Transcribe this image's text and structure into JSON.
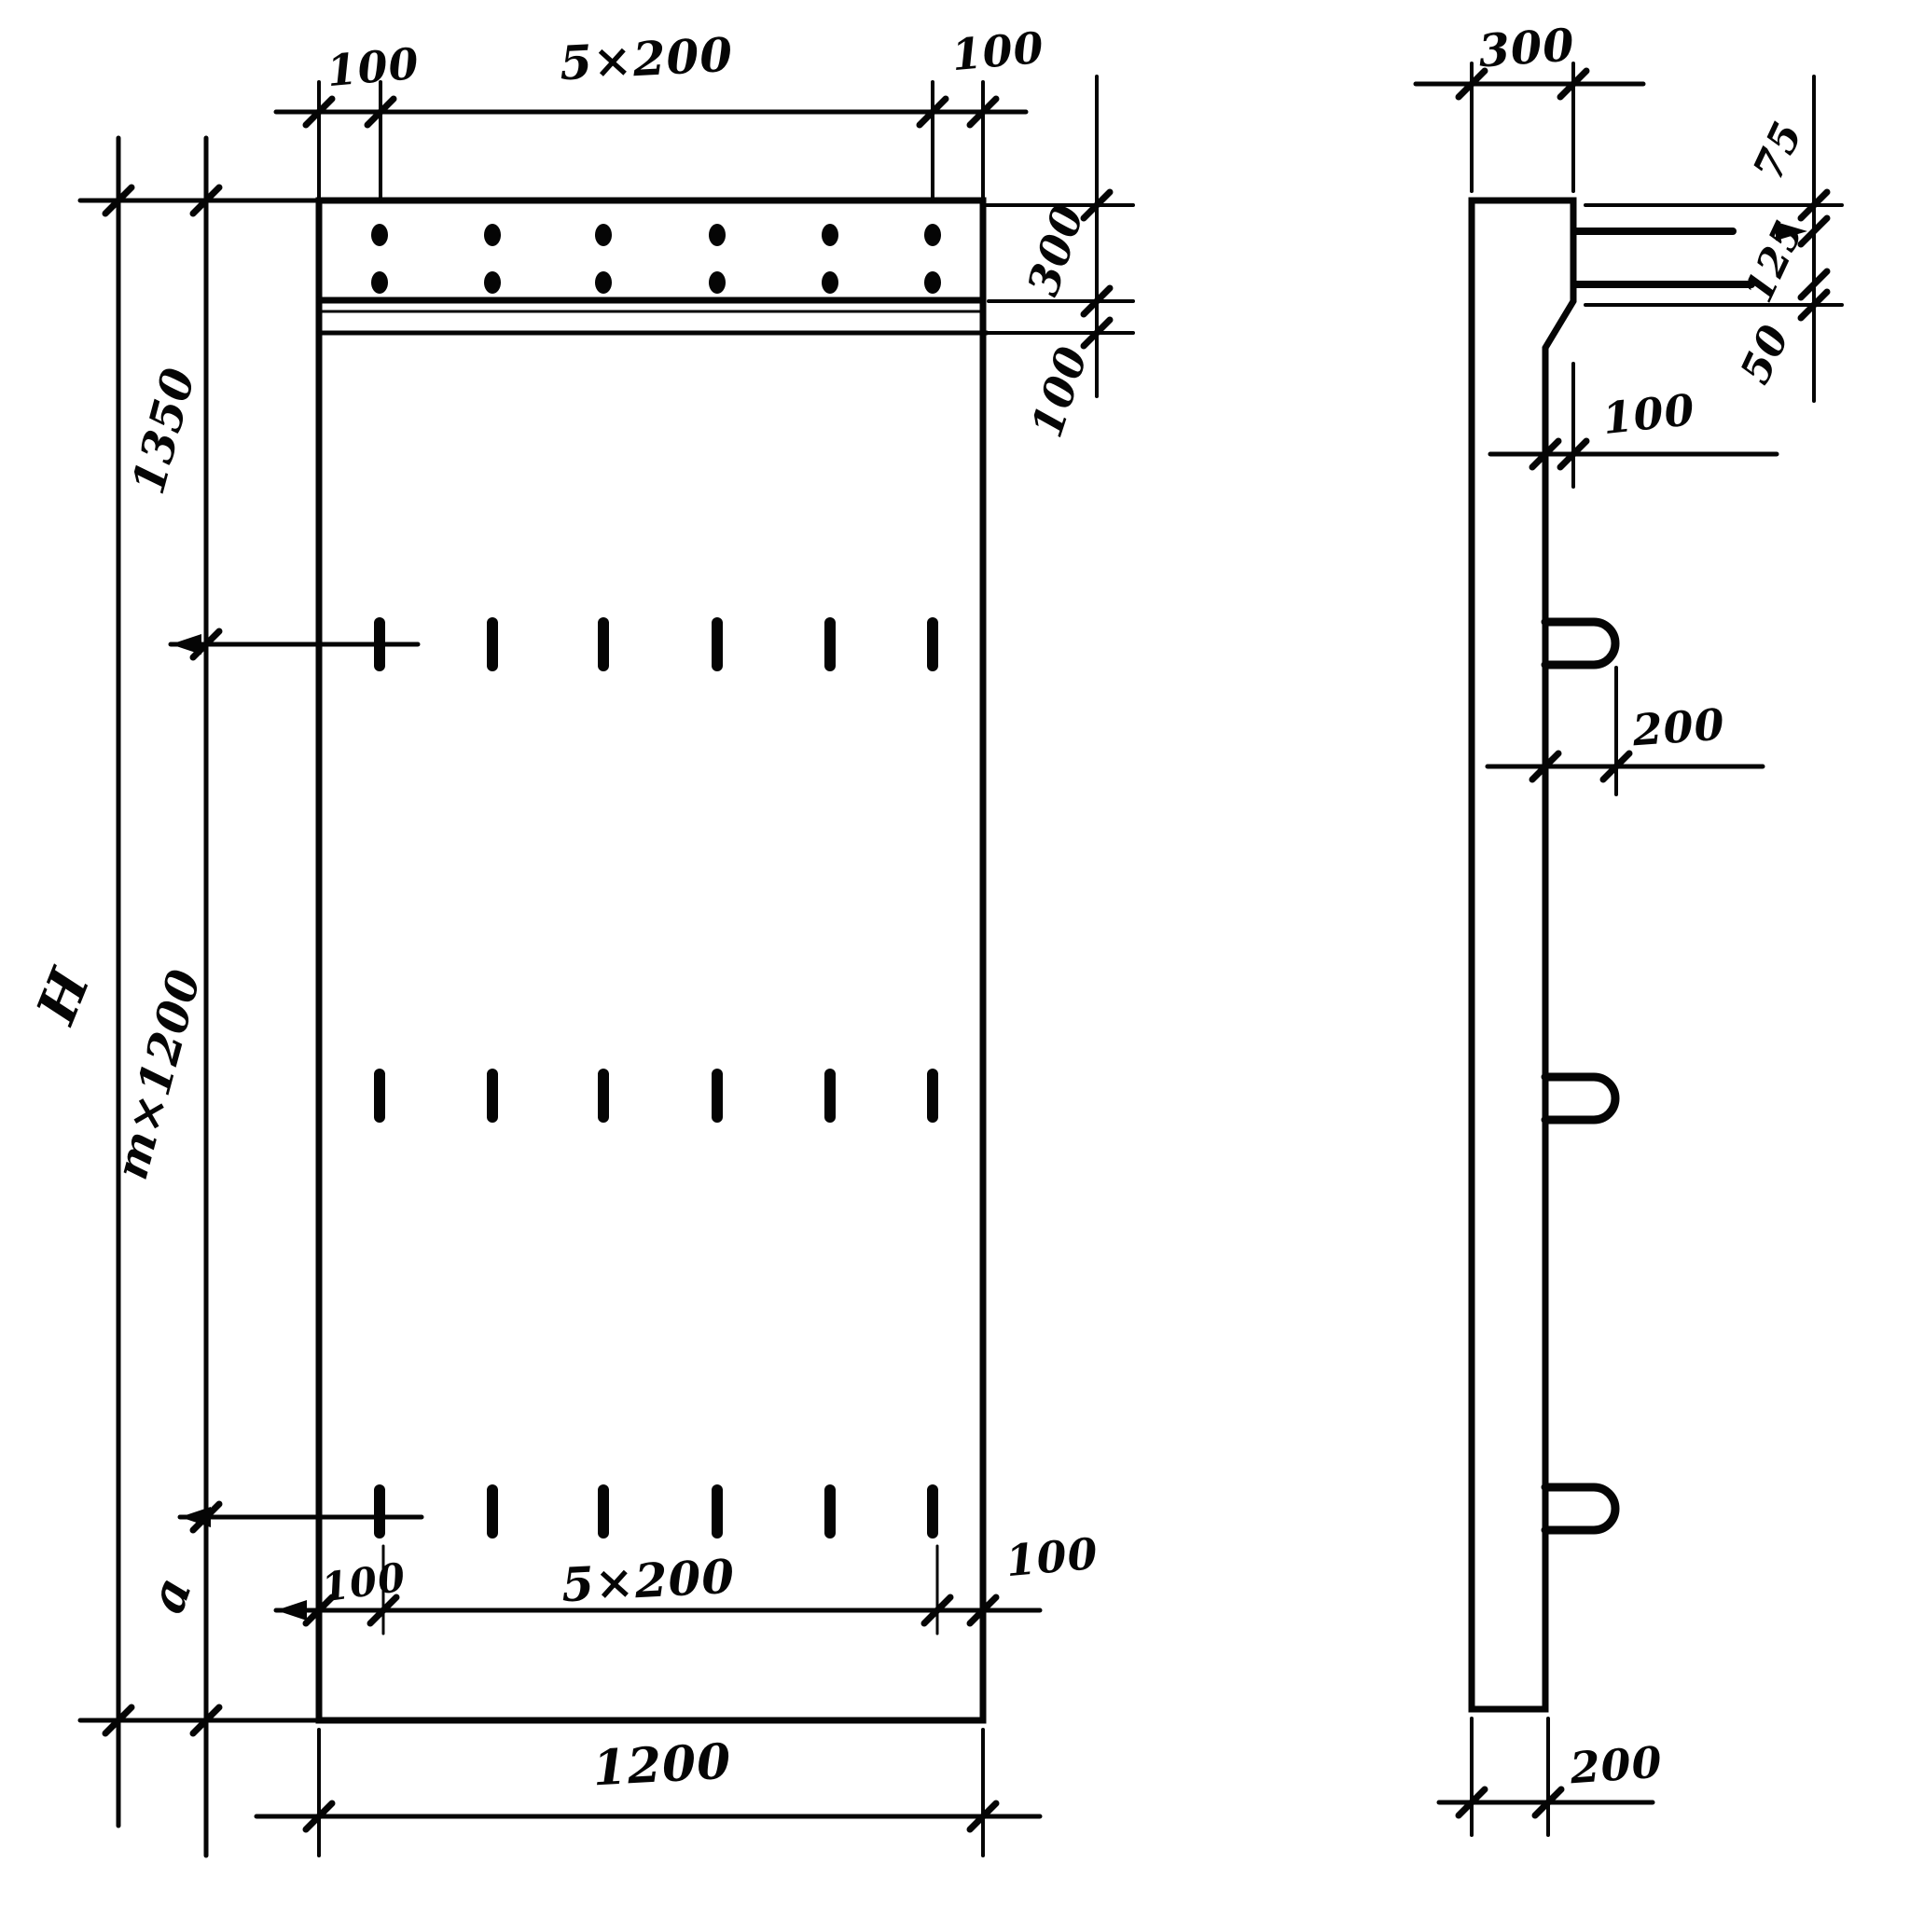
{
  "front_view": {
    "top_dimension": {
      "left_margin": "100",
      "spacing": "5×200",
      "right_margin": "100"
    },
    "right_dimension": {
      "cap_height": "300",
      "gap": "100"
    },
    "left_dimension": {
      "top_segment": "1350",
      "middle_segment": "m×1200",
      "bottom_segment": "a",
      "total_height": "H"
    },
    "bottom_tie_dimension": {
      "left_margin": "100",
      "spacing": "5×200",
      "right_margin": "100"
    },
    "bottom_dimension": {
      "width": "1200"
    }
  },
  "side_view": {
    "top_dimension": {
      "thickness": "300"
    },
    "bar_dimension": {
      "top_offset": "75",
      "bar_spacing": "125",
      "bottom_offset": "50"
    },
    "step_dimension": {
      "offset": "100"
    },
    "loop_dimension": {
      "protrusion": "200"
    },
    "bottom_dimension": {
      "thickness": "200"
    }
  }
}
